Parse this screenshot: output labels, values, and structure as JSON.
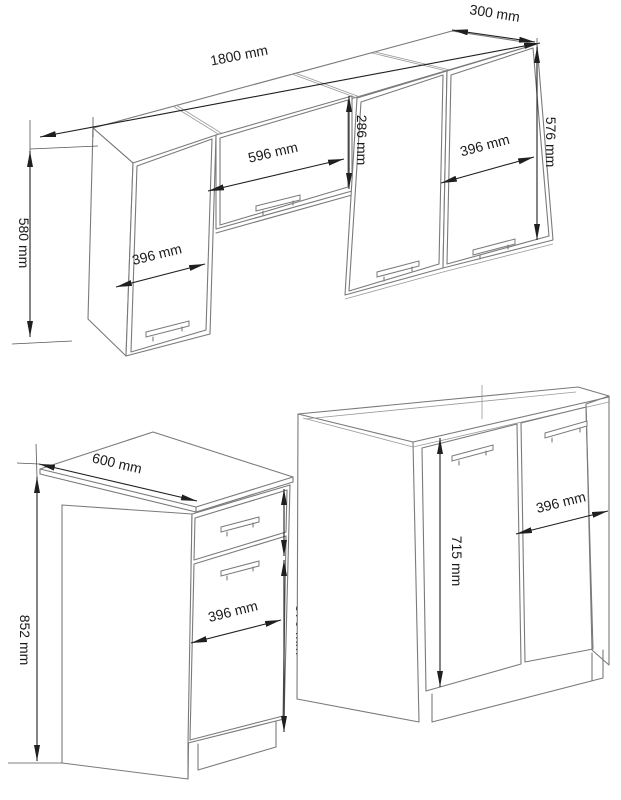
{
  "page": {
    "background": "#ffffff"
  },
  "diagram": {
    "title": "kitchen-set-dimension-diagram",
    "colors": {
      "cabinet_line": "#7a7a7a",
      "dimension_line": "#1f1f1f",
      "text": "#1a1a1a"
    },
    "wall_unit": {
      "dims": {
        "total_width": "1800 mm",
        "depth": "300 mm",
        "left_cabinet_height": "580 mm",
        "left_door_width": "396 mm",
        "flip_cabinet_door_width": "596 mm",
        "flip_cabinet_height": "286 mm",
        "right_cabinet_height": "576 mm",
        "right_door_width": "396 mm"
      }
    },
    "base_cabinet": {
      "dims": {
        "worktop_depth": "600 mm",
        "total_height": "852 mm",
        "drawer_front_height": "140 mm",
        "door_height": "570 mm",
        "door_width": "396 mm"
      }
    },
    "sink_cabinet": {
      "dims": {
        "door_height": "715 mm",
        "door_width": "396 mm"
      }
    }
  }
}
